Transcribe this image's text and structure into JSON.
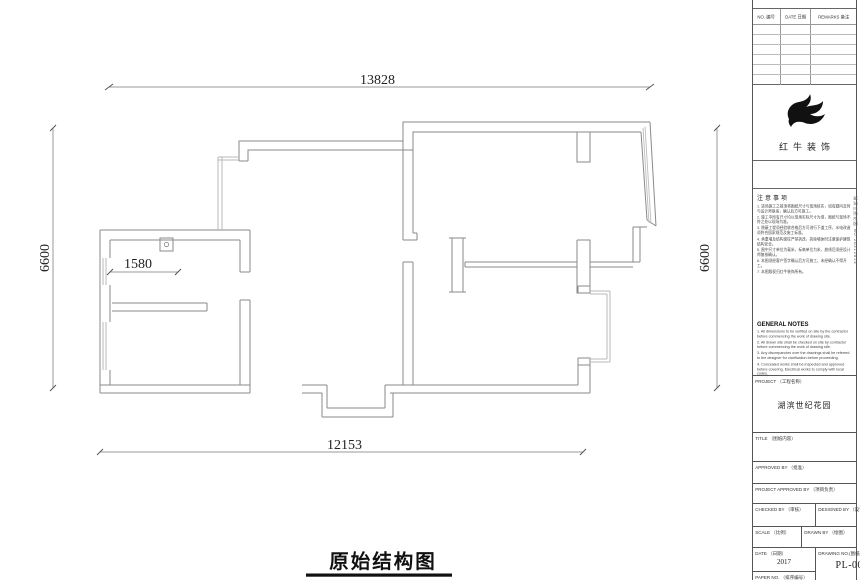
{
  "plan": {
    "title": "原始结构图",
    "dims": {
      "top": "13828",
      "left": "6600",
      "right": "6600",
      "bottom": "12153",
      "inner": "1580"
    }
  },
  "titleblock": {
    "log_table": {
      "headers": [
        "NO. 编号",
        "DATE 日期",
        "REMARKS 备注"
      ]
    },
    "brand": {
      "name": "红牛装饰",
      "logo": "bull-swoosh"
    },
    "side_text": "湖滨世纪花园 NO.20312014",
    "notes_cn": {
      "heading": "注意事项",
      "items": [
        "1. 进场施工之前须将图纸尺寸与现场核实，如有疑问及时与设计师联系，确认后方可施工。",
        "2. 施工中所有尺寸均以现场实际尺寸为准，图纸与现场不符之处以现场为准。",
        "3. 隐蔽工程须经验收合格后方可进行下道工序，水电改造须符合国家规范及施工标准。",
        "4. 承重墙及结构梁柱严禁拆改，拆除墙体时注意保护建筑结构安全。",
        "5. 图中尺寸单位为毫米，标高单位为米，放线后须经设计师复核确认。",
        "6. 本图须经客户签字确认后方可施工，未经确认不得开工。",
        "7. 本图版权归红牛装饰所有。"
      ]
    },
    "notes_en": {
      "heading": "GENERAL NOTES",
      "items": [
        "1. All dimensions to be verified on site by the contractor before commencing the work of drawing site.",
        "2. All drawn site shall be checked on site by contractor before commencing the work of drawing site.",
        "3. Any discrepancies over the drawings shall be referred to the designer for clarification before proceeding.",
        "4. Concealed works shall be inspected and approved before covering. Electrical works to comply with local codes.",
        "5. All structural walls, beams and columns shall not be demolished or altered.",
        "6. All dimensions are in millimeters unless otherwise noted.",
        "7. This drawing remains the property of the design company.",
        "8. Do not scale drawings."
      ]
    },
    "fields": {
      "project_label": "PROJECT （工程名称）",
      "project_value": "湖滨世纪花园",
      "title_label": "TITLE （图纸内容）",
      "approved_label": "APPROVED BY （批准）",
      "proj_approved_label": "PROJECT APPROVED BY （项目负责）",
      "checked_label": "CHECKED BY （审核）",
      "designed_label": "DESIGNED BY （设计）",
      "scale_label": "SCALE （比例）",
      "drawn_label": "DRAWN BY （绘图）",
      "date_label": "DATE （日期）",
      "date_value": "2017",
      "drawing_no_label": "DRAWING NO.(图纸编号)",
      "drawing_no_value": "PL-000",
      "paper_no_label": "PAPER NO. （排序编号）"
    }
  }
}
